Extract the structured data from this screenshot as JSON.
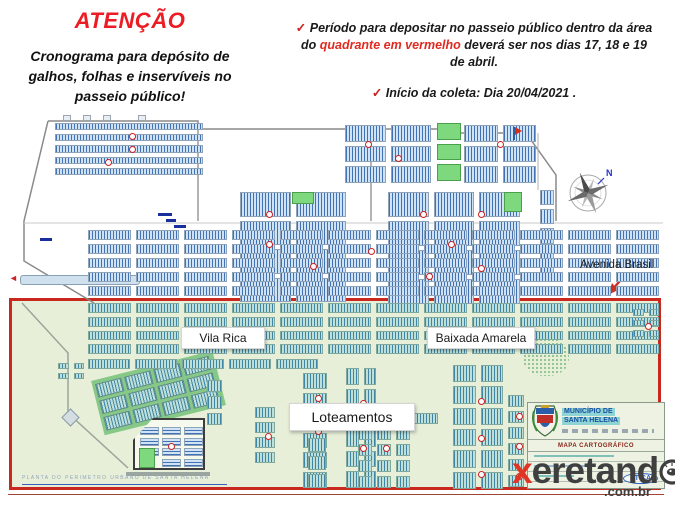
{
  "header": {
    "attention": "ATENÇÃO",
    "subtitle_lines": [
      "Cronograma para depósito de",
      "galhos, folhas e inservíveis no",
      "passeio público!"
    ]
  },
  "notices": {
    "check": "✓",
    "n1_line1": "Período para depositar no passeio público dentro da área",
    "n1_line2_pre": "do ",
    "n1_line2_red": "quadrante em vermelho",
    "n1_line2_post": " deverá ser nos dias 17, 18 e 19",
    "n1_line3": "de abril.",
    "n2": "Início da coleta: Dia 20/04/2021 ."
  },
  "map": {
    "avenida_label": "Avenida Brasil",
    "vila_rica_label": "Vila Rica",
    "baixada_label": "Baixada Amarela",
    "loteamentos_label": "Loteamentos",
    "compass_north": "N",
    "plate_caption": "PLANTA DO PERIMETRO URBANO DE SANTA HELENA",
    "title_block": {
      "municipality_line1": "MUNICÍPIO DE",
      "municipality_line2": "SANTA HELENA",
      "band": "MAPA CARTOGRÁFICO",
      "stamp": "ÉTICA"
    }
  },
  "watermark": {
    "x": "x",
    "body": "eretand",
    "domain": ".com.br"
  },
  "colors": {
    "attention_red": "#ed1c24",
    "highlight_red": "#e02b20",
    "quadrant_border": "#c8281e",
    "quadrant_fill": "#e7efd9",
    "block_blue": "#2a5ea8",
    "block_teal": "#2e7e9e"
  }
}
